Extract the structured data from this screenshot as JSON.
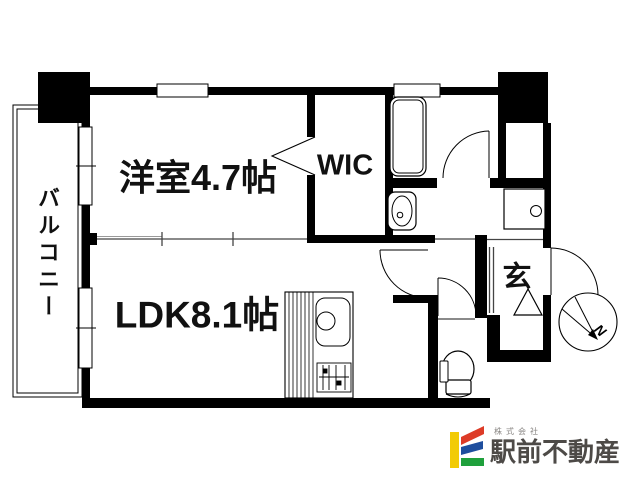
{
  "floorplan": {
    "rooms": {
      "western_room": {
        "label": "洋室4.7帖"
      },
      "wic": {
        "label": "WIC"
      },
      "ldk": {
        "label": "LDK8.1帖"
      },
      "balcony": {
        "label": "バルコニー"
      },
      "entrance": {
        "label": "玄"
      }
    },
    "compass": {
      "label": "N"
    },
    "line_color": "#000000"
  },
  "logo": {
    "company_prefix": "株式会社",
    "company_name": "駅前不動産",
    "colors": {
      "yellow": "#F2CB05",
      "red": "#DD3B27",
      "blue": "#1E4E9E",
      "green": "#1FA03C",
      "text": "#4d4a47"
    }
  }
}
